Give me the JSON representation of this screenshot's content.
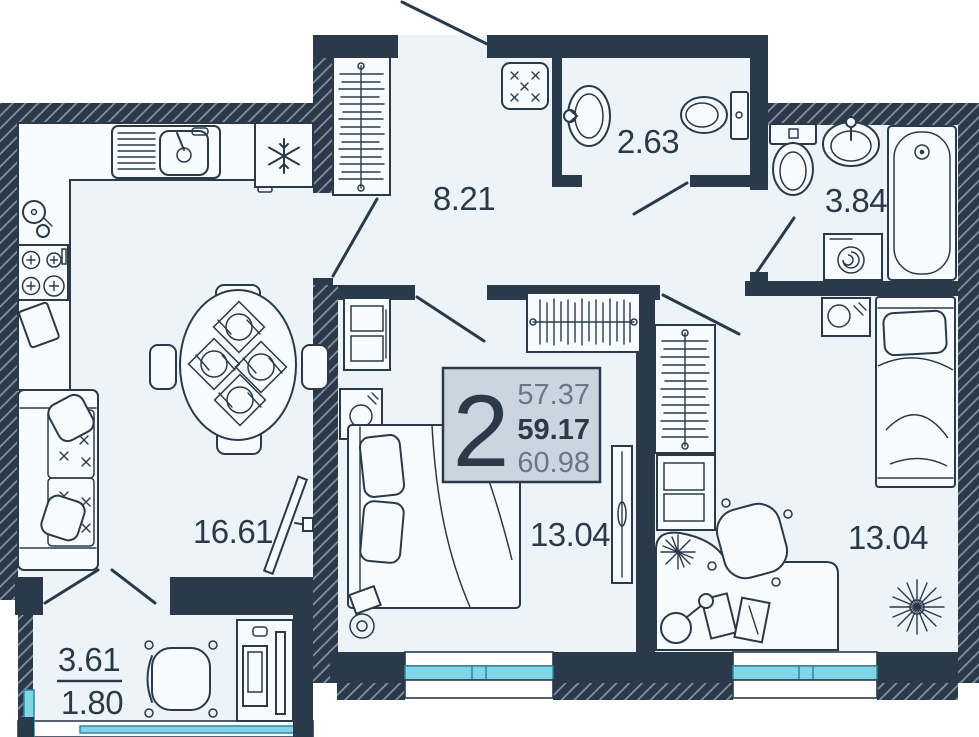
{
  "floor_plan": {
    "unit_card": {
      "rooms_count": "2",
      "area_living": "57.37",
      "area_total": "59.17",
      "area_total_with_summer": "60.98"
    },
    "room_labels": {
      "hallway": "8.21",
      "wc": "2.63",
      "bathroom": "3.84",
      "kitchen_living_room": "16.61",
      "bedroom_1": "13.04",
      "bedroom_2": "13.04",
      "balcony_full": "3.61",
      "balcony_reduced": "1.80"
    },
    "colors": {
      "wall": "#2b3a4a",
      "floor": "#edf4f9",
      "glazing": "#82d5e6",
      "card_background": "#cbd5dd",
      "text_muted": "#68788a"
    }
  }
}
